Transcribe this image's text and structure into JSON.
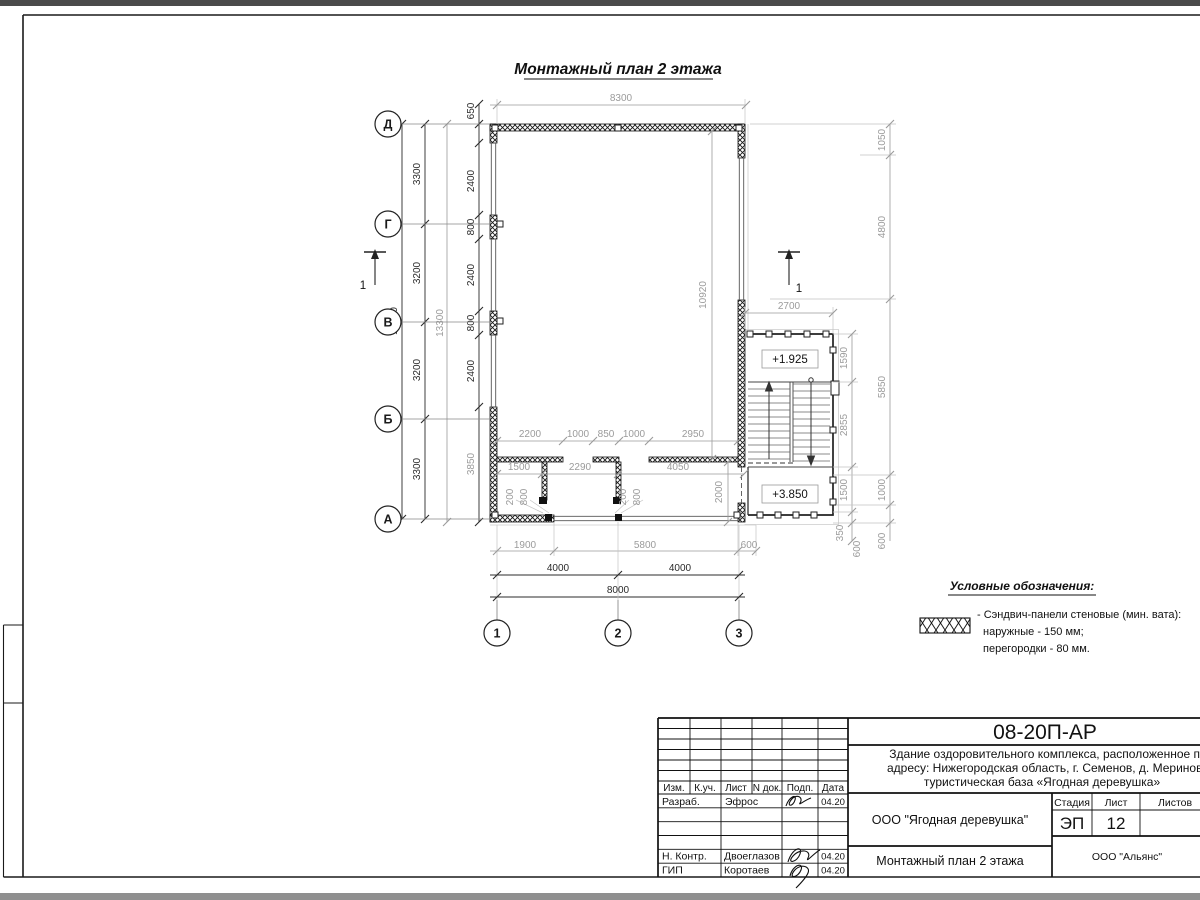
{
  "colors": {
    "paper": "#ffffff",
    "line": "#1a1a1a",
    "dim_gray": "#9b9b9b",
    "chrome": "#4b4b4b"
  },
  "sheet": {
    "plan_title": "Монтажный план 2 этажа",
    "axes_rows": [
      "Д",
      "Г",
      "В",
      "Б",
      "А"
    ],
    "axes_cols": [
      "1",
      "2",
      "3"
    ],
    "section_label": "1",
    "elevation_upper": "+1.925",
    "elevation_lower": "+3.850"
  },
  "dims": {
    "top_width": "8300",
    "axis_spans": [
      "3300",
      "3200",
      "3200",
      "3300"
    ],
    "axis_total": "13000",
    "inner_total": "13300",
    "wall_chain": [
      "650",
      "2400",
      "800",
      "2400",
      "800",
      "2400",
      "3850"
    ],
    "hall_height": "10920",
    "part_top": [
      "2200",
      "1000",
      "850",
      "1000",
      "2950"
    ],
    "rooms": [
      "1500",
      "2290",
      "4050"
    ],
    "door1": [
      "200",
      "800"
    ],
    "door2": [
      "200",
      "800"
    ],
    "room_depth": "2000",
    "stair_top": "2700",
    "stair_side": [
      "1590",
      "2855",
      "1500",
      "350",
      "600"
    ],
    "right_side": [
      "1050",
      "4800",
      "5850",
      "1000",
      "600"
    ],
    "bottom_inner": [
      "1900",
      "5800",
      "600"
    ],
    "bottom_axis": [
      "4000",
      "4000"
    ],
    "bottom_total": "8000"
  },
  "legend": {
    "title": "Условные обозначения:",
    "line1": "- Сэндвич-панели стеновые (мин. вата):",
    "line2": "наружные - 150 мм;",
    "line3": "перегородки - 80 мм."
  },
  "titleblock": {
    "doc_number": "08-20П-АР",
    "project_line1": "Здание оздоровительного комплекса, расположенное по",
    "project_line2": "адресу: Нижегородская область, г. Семенов, д. Мериново",
    "project_line3": "туристическая база «Ягодная деревушка»",
    "header_cols": [
      "Изм.",
      "К.уч.",
      "Лист",
      "N док.",
      "Подп.",
      "Дата"
    ],
    "rows": [
      {
        "role": "Разраб.",
        "name": "Эфрос",
        "date": "04.20"
      },
      {
        "role": "Н. Контр.",
        "name": "Двоеглазов",
        "date": "04.20"
      },
      {
        "role": "ГИП",
        "name": "Коротаев",
        "date": "04.20"
      }
    ],
    "org": "ООО \"Ягодная деревушка\"",
    "stage_label": "Стадия",
    "sheet_label": "Лист",
    "sheets_label": "Листов",
    "stage": "ЭП",
    "sheet_number": "12",
    "drawing_name": "Монтажный план 2 этажа",
    "company": "ООО \"Альянс\""
  }
}
